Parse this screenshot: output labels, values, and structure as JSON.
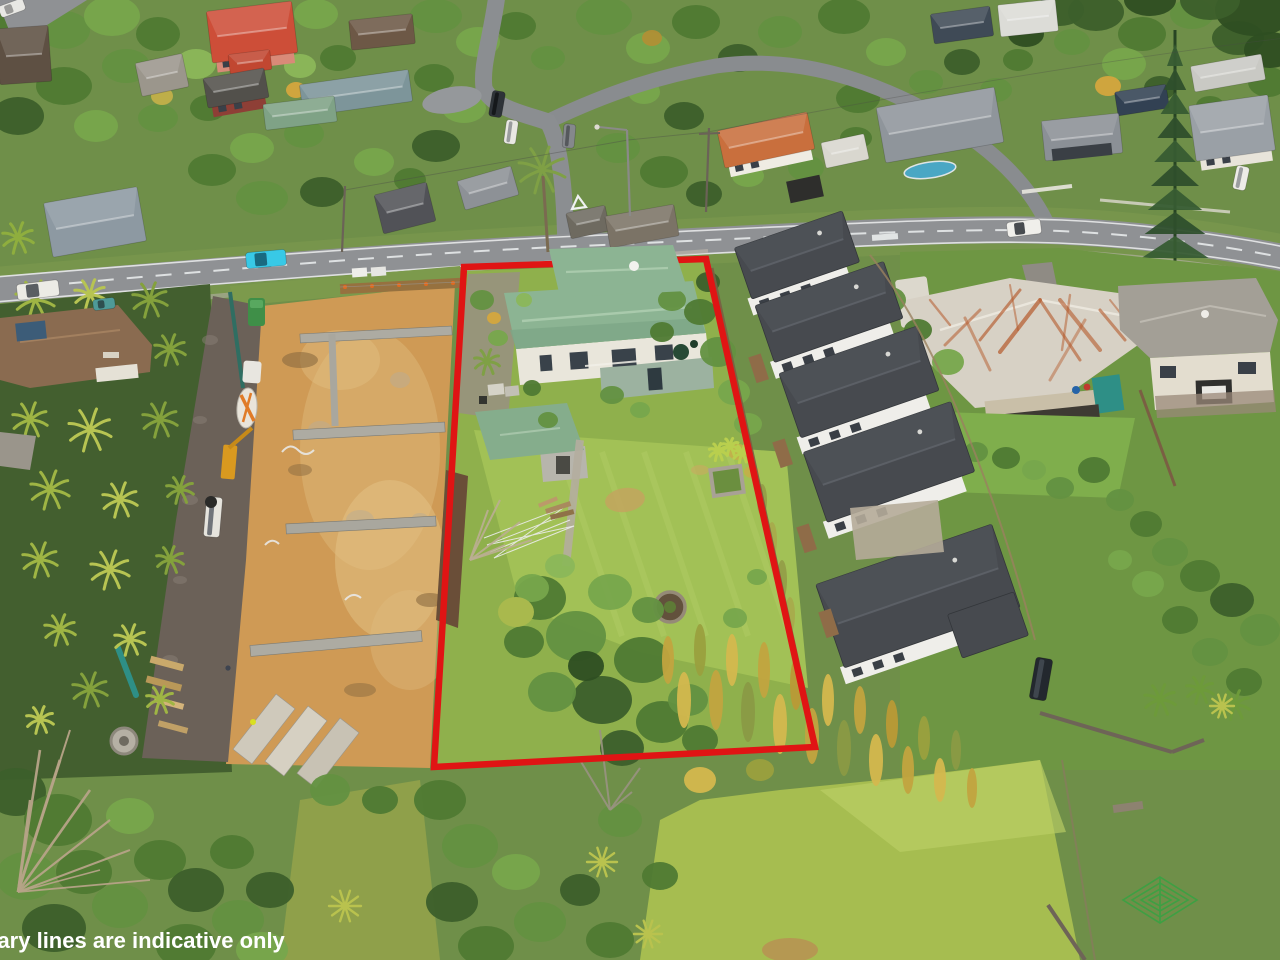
{
  "image": {
    "kind": "aerial-drone-real-estate-photo",
    "description": "Aerial view of a suburban section outlined in red, between a construction site and a row of new townhouses"
  },
  "caption": {
    "text": "dary lines are indicative only",
    "color": "#ffffff"
  },
  "boundary": {
    "color": "#e01414",
    "stroke_width": 6.5,
    "points": "464,267 706,259 815,747 434,767"
  },
  "colors": {
    "base_green": "#6f8f49",
    "lawn": "#a2c156",
    "lawn_light": "#bcd36d",
    "paddock": "#a6bd50",
    "road": "#8f9194",
    "dirt": "#cf9a55",
    "dirt_light": "#e2bb7c",
    "subject_roof": "#8cb493",
    "subject_roof_light": "#a6c8aa",
    "shed_roof": "#85ad8c",
    "townhouse_roof": "#474a4f",
    "townhouse_wall": "#efeeea",
    "villa_roof": "#d7d1c5",
    "rust": "#b55a2c",
    "cyan_car": "#38c9e6",
    "fence_brown": "#8a6b49"
  },
  "objects": [
    "red-boundary-outline",
    "subject-property",
    "subject-house-green-roof",
    "garden-shed",
    "backyard-lawn",
    "garden-circle",
    "clothesline",
    "construction-site",
    "concrete-terraces",
    "concrete-mixer-truck",
    "concrete-pump",
    "work-ute",
    "portaloo",
    "palm-trees",
    "townhouse-row",
    "old-villa-rusty-roof",
    "two-storey-house",
    "main-road",
    "side-street",
    "street-lamp",
    "power-poles",
    "norfolk-pine",
    "dead-tree",
    "climbing-frame",
    "paddock-lawn",
    "parked-cars",
    "caption-text"
  ]
}
